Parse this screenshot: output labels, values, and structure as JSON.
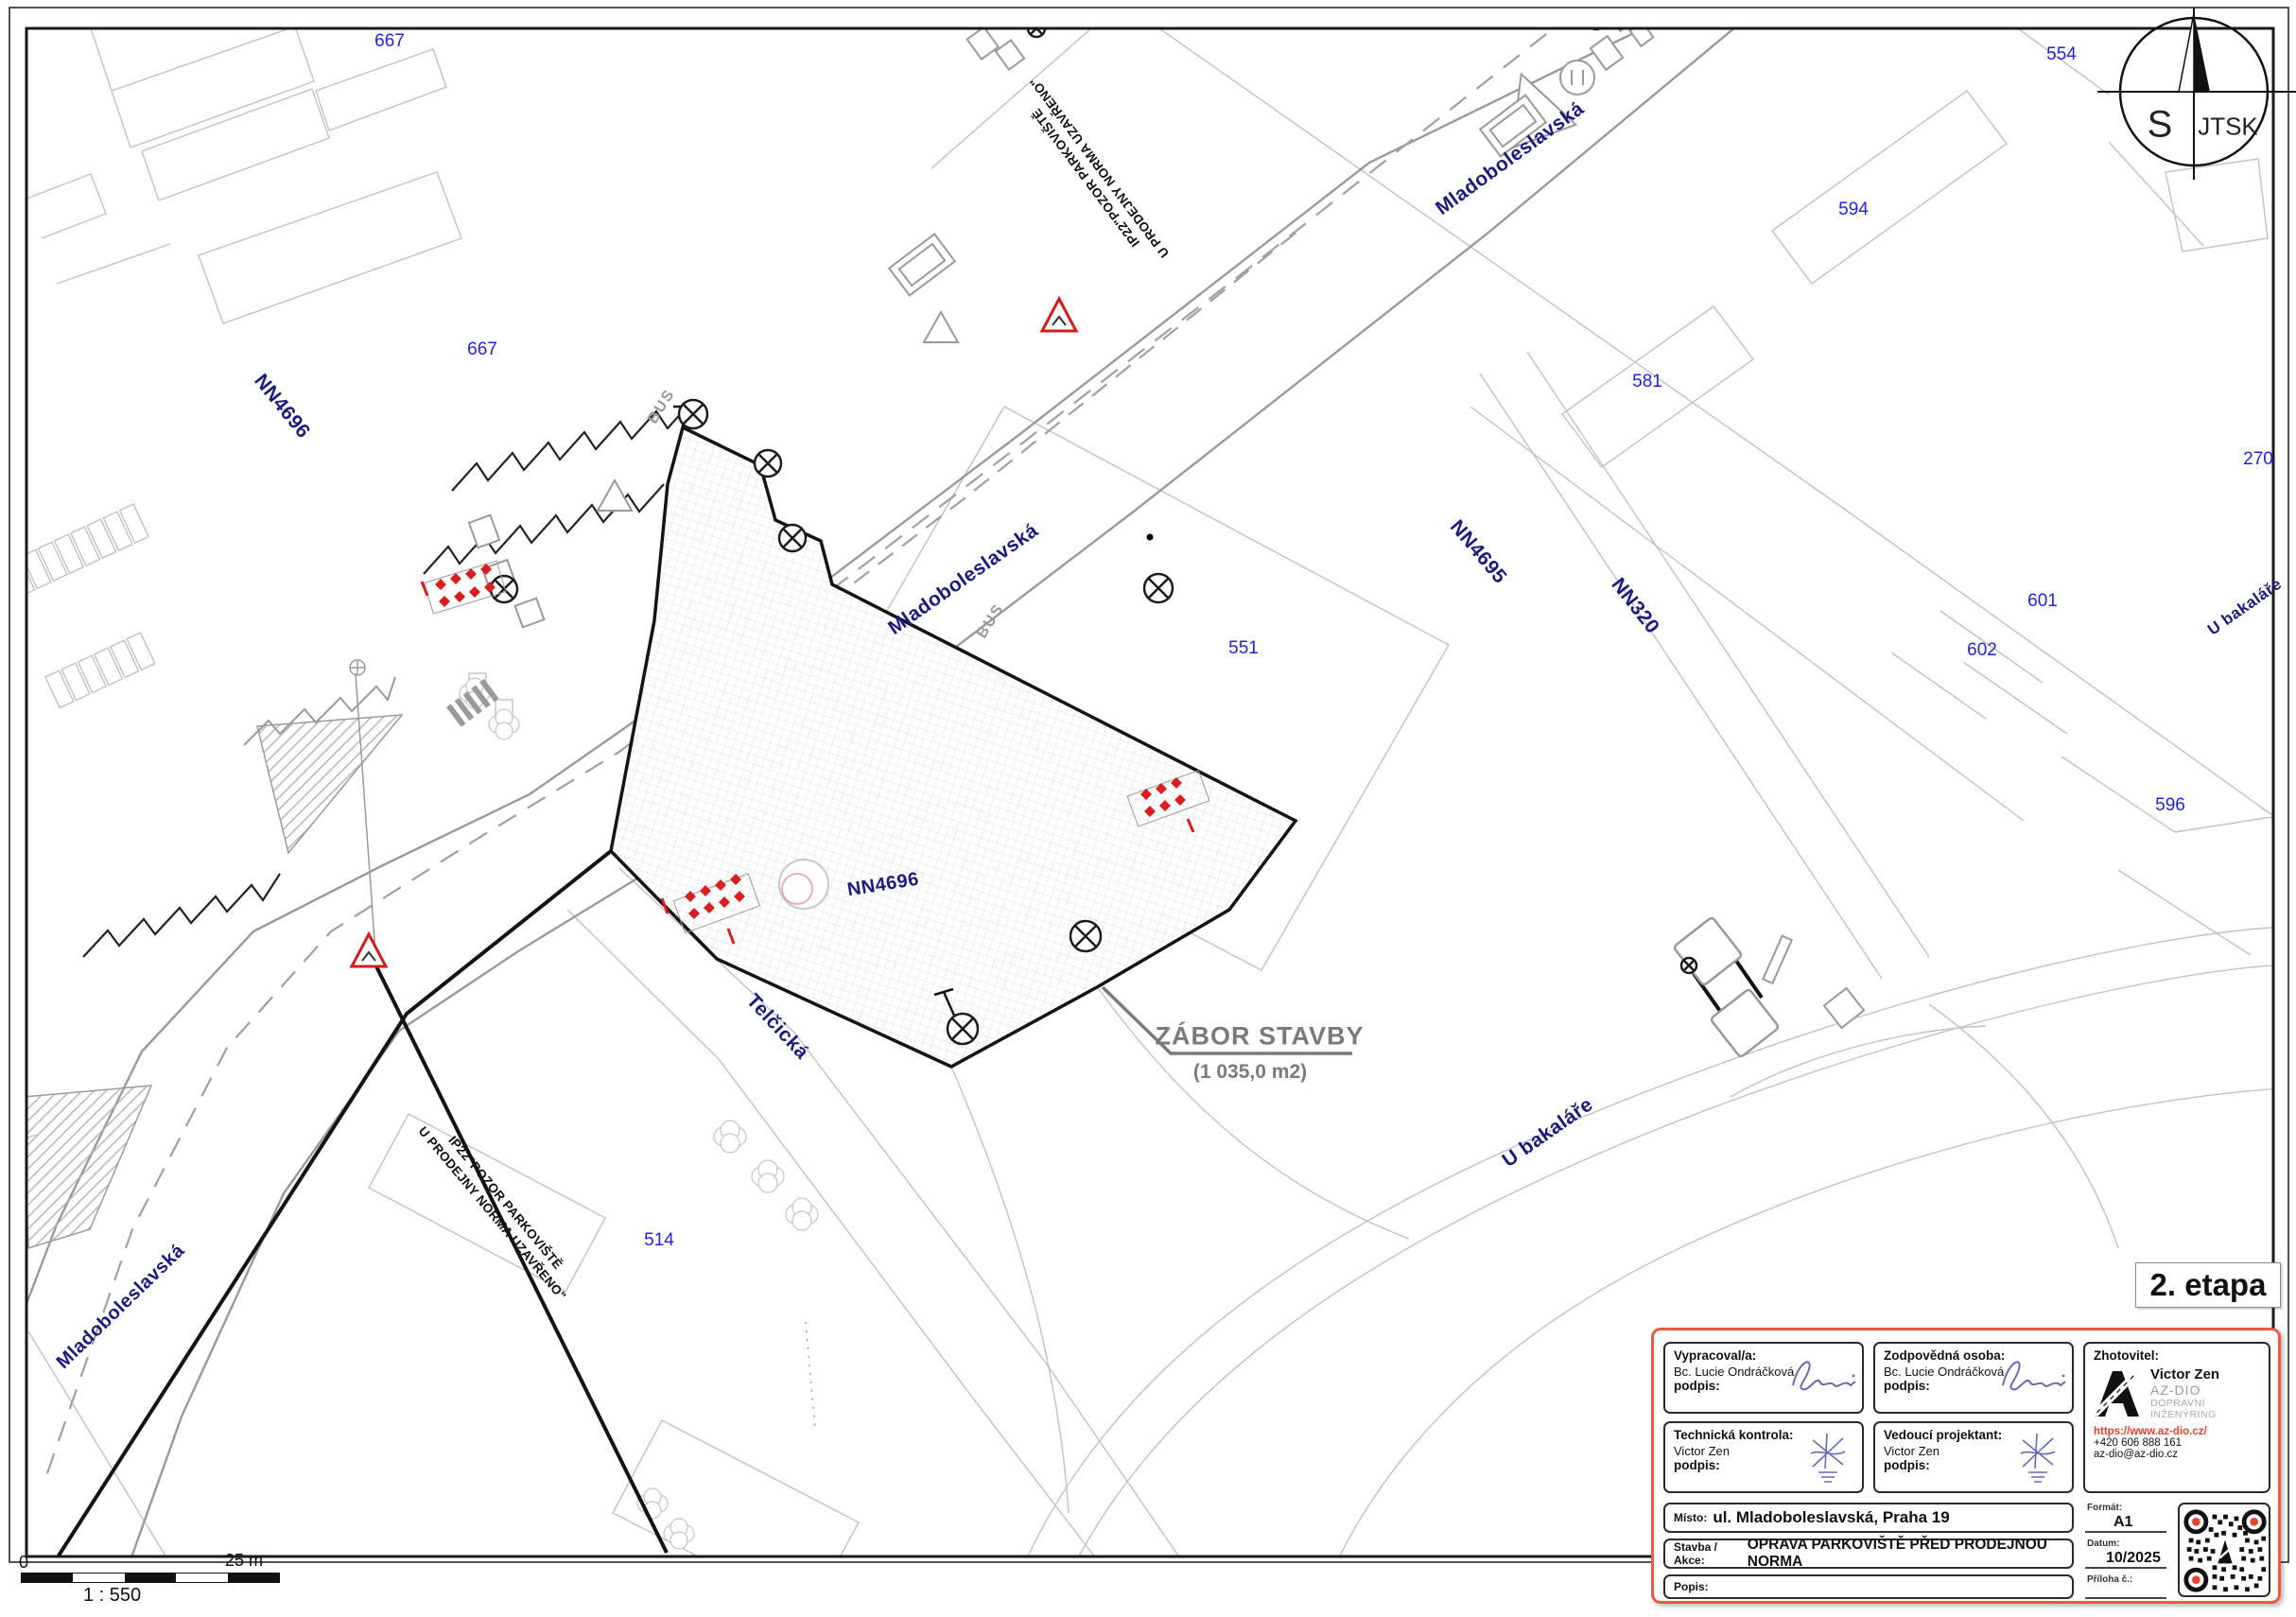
{
  "drawing": {
    "stage_label": "2. etapa",
    "zabor_title": "ZÁBOR STAVBY",
    "zabor_area": "(1 035,0 m2)",
    "warning_note_line1": "IP22\"POZOR PARKOVIŠTĚ",
    "warning_note_line2": "U PRODEJNY NORMA UZAVŘENO\"",
    "bus_marking": "BUS"
  },
  "compass": {
    "south": "S",
    "grid": "JTSK"
  },
  "scale_bar": {
    "zero": "0",
    "length": "25 m",
    "ratio": "1 : 550"
  },
  "streets": [
    "NN4696",
    "Mladoboleslavská",
    "Mladoboleslavská",
    "Mladoboleslavská",
    "NN4695",
    "NN320",
    "NN4696",
    "Telčická",
    "U bakaláře",
    "U bakaláře"
  ],
  "parcels": [
    "667",
    "667",
    "554",
    "594",
    "581",
    "270",
    "601",
    "602",
    "596",
    "551",
    "514"
  ],
  "title_block": {
    "prepared_by_label": "Vypracoval/a:",
    "prepared_by_name": "Bc. Lucie Ondráčková",
    "signature_label": "podpis:",
    "responsible_label": "Zodpovědná osoba:",
    "responsible_name": "Bc. Lucie Ondráčková",
    "technical_check_label": "Technická kontrola:",
    "technical_check_name": "Victor Zen",
    "lead_designer_label": "Vedoucí projektant:",
    "lead_designer_name": "Victor Zen",
    "contractor_label": "Zhotovitel:",
    "contractor_name": "Victor Zen",
    "contractor_company": "AZ-DIO",
    "contractor_tagline": "DOPRAVNÍ INŽENÝRING",
    "contractor_url": "https://www.az-dio.cz/",
    "contractor_phone": "+420 606 888 161",
    "contractor_email": "az-dio@az-dio.cz",
    "place_label": "Místo:",
    "place_value": "ul. Mladoboleslavská, Praha 19",
    "project_label": "Stavba / Akce:",
    "project_value": "OPRAVA PARKOVIŠTĚ PŘED PRODEJNOU NORMA",
    "description_label": "Popis:",
    "format_label": "Formát:",
    "format_value": "A1",
    "date_label": "Datum:",
    "date_value": "10/2025",
    "attachment_label": "Příloha č.:"
  },
  "colors": {
    "accent_red": "#f05940",
    "link_red": "#e8402a",
    "street_navy": "#1b1b7e",
    "parcel_blue": "#2323dd",
    "work_red": "#d81f1f"
  }
}
